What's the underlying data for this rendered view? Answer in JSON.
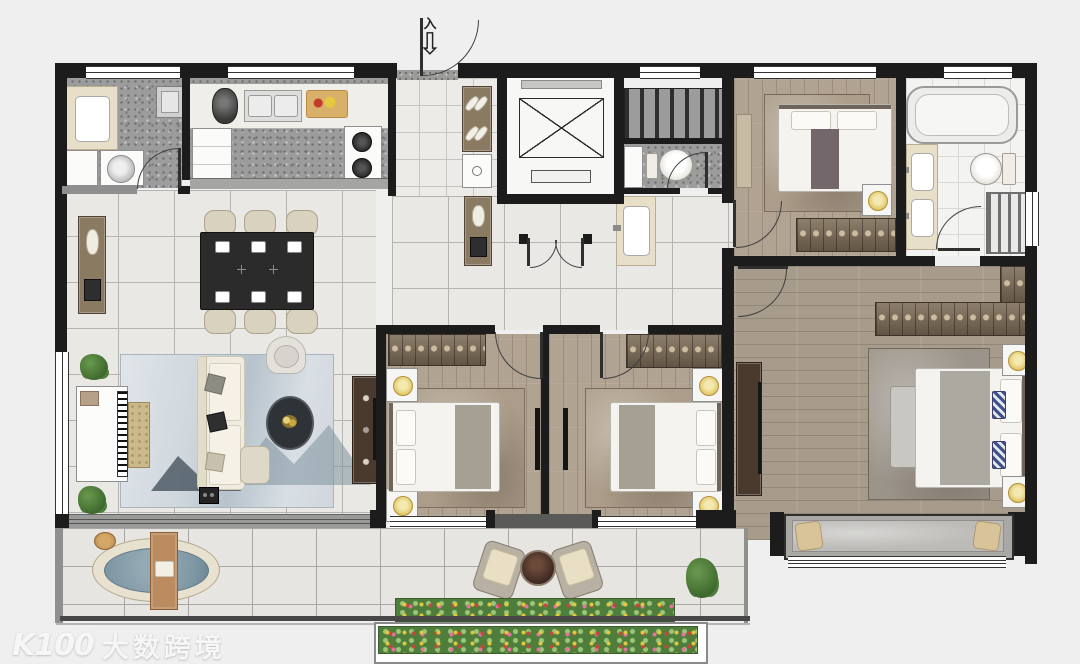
{
  "entry": {
    "marker": "入"
  },
  "watermark": {
    "logo_text": "K100",
    "brand_text": "大数跨境"
  },
  "palette": {
    "bg": "#efefef",
    "wall": "#1c1c1c",
    "wall-gray": "#8f8f8f",
    "tile": "#e9e8e5",
    "tile-line": "#b5b4b0",
    "terrazzo": "#9c9c9c",
    "wood": "#b1a392",
    "wood-master": "#a79c8b",
    "bath-tile": "#f3f3f1",
    "rug-living": "#c7d0d7",
    "rug-bed": "#ab9d89",
    "sofa": "#efebdf",
    "wardrobe": "#7a6a54",
    "cabinet": "#8b7a62",
    "counter": "#e8dfc8",
    "gold": "#e7d07a",
    "water": "#7e97a3",
    "plant": "#4e7d3a",
    "table-dark": "#2b2b2b",
    "flower-red": "#c2493b",
    "flower-yellow": "#e4c93f",
    "flower-pink": "#e773a1"
  },
  "rooms": [
    {
      "id": "laundry",
      "name": "Laundry / utility room",
      "furniture": [
        "sink vanity",
        "mop basin",
        "washing machine",
        "cabinet"
      ]
    },
    {
      "id": "kitchen",
      "name": "Kitchen",
      "furniture": [
        "counter",
        "coffee maker",
        "double sink",
        "cutting board",
        "refrigerator",
        "gas stove"
      ]
    },
    {
      "id": "foyer",
      "name": "Entry foyer",
      "furniture": [
        "shoe cabinet",
        "slippers",
        "low cabinet"
      ]
    },
    {
      "id": "elevator",
      "name": "Elevator",
      "furniture": []
    },
    {
      "id": "stairwell",
      "name": "Stairwell",
      "furniture": []
    },
    {
      "id": "guest-wc",
      "name": "Guest toilet",
      "furniture": [
        "toilet",
        "shelf"
      ]
    },
    {
      "id": "hallway",
      "name": "Hallway",
      "furniture": [
        "cabinet",
        "wash basin",
        "double doors"
      ]
    },
    {
      "id": "dining-living",
      "name": "Dining and living room",
      "furniture": [
        "sideboard",
        "dining table",
        "6 chairs",
        "piano",
        "piano bench",
        "mountain-print rug",
        "sofa",
        "armchair",
        "round coffee table",
        "ottoman",
        "TV console",
        "wall TV",
        "plants",
        "speaker"
      ]
    },
    {
      "id": "bedroom-2",
      "name": "Bedroom 2",
      "furniture": [
        "wardrobe",
        "double bed",
        "2 nightstands with lamps",
        "rug",
        "wall TV"
      ]
    },
    {
      "id": "bedroom-3",
      "name": "Bedroom 3",
      "furniture": [
        "wardrobe",
        "double bed",
        "2 nightstands with lamps",
        "rug",
        "wall TV"
      ]
    },
    {
      "id": "bedroom-4",
      "name": "Bedroom 4",
      "furniture": [
        "desk ledge",
        "double bed",
        "nightstand with lamp",
        "wardrobe",
        "rug"
      ]
    },
    {
      "id": "master-bathroom",
      "name": "Master bathroom",
      "furniture": [
        "bathtub",
        "double vanity",
        "toilet",
        "shower rack"
      ]
    },
    {
      "id": "master-bedroom",
      "name": "Master bedroom",
      "furniture": [
        "L-shaped wardrobe",
        "dresser with TV",
        "king bed",
        "2 nightstands with lamps",
        "foot bench",
        "rug",
        "bay window seat"
      ]
    },
    {
      "id": "balcony",
      "name": "South balcony",
      "furniture": [
        "soaking tub",
        "bath caddy",
        "2 loungers",
        "round table",
        "flower bed",
        "plant"
      ]
    },
    {
      "id": "planter",
      "name": "Flower planter box",
      "furniture": []
    }
  ]
}
